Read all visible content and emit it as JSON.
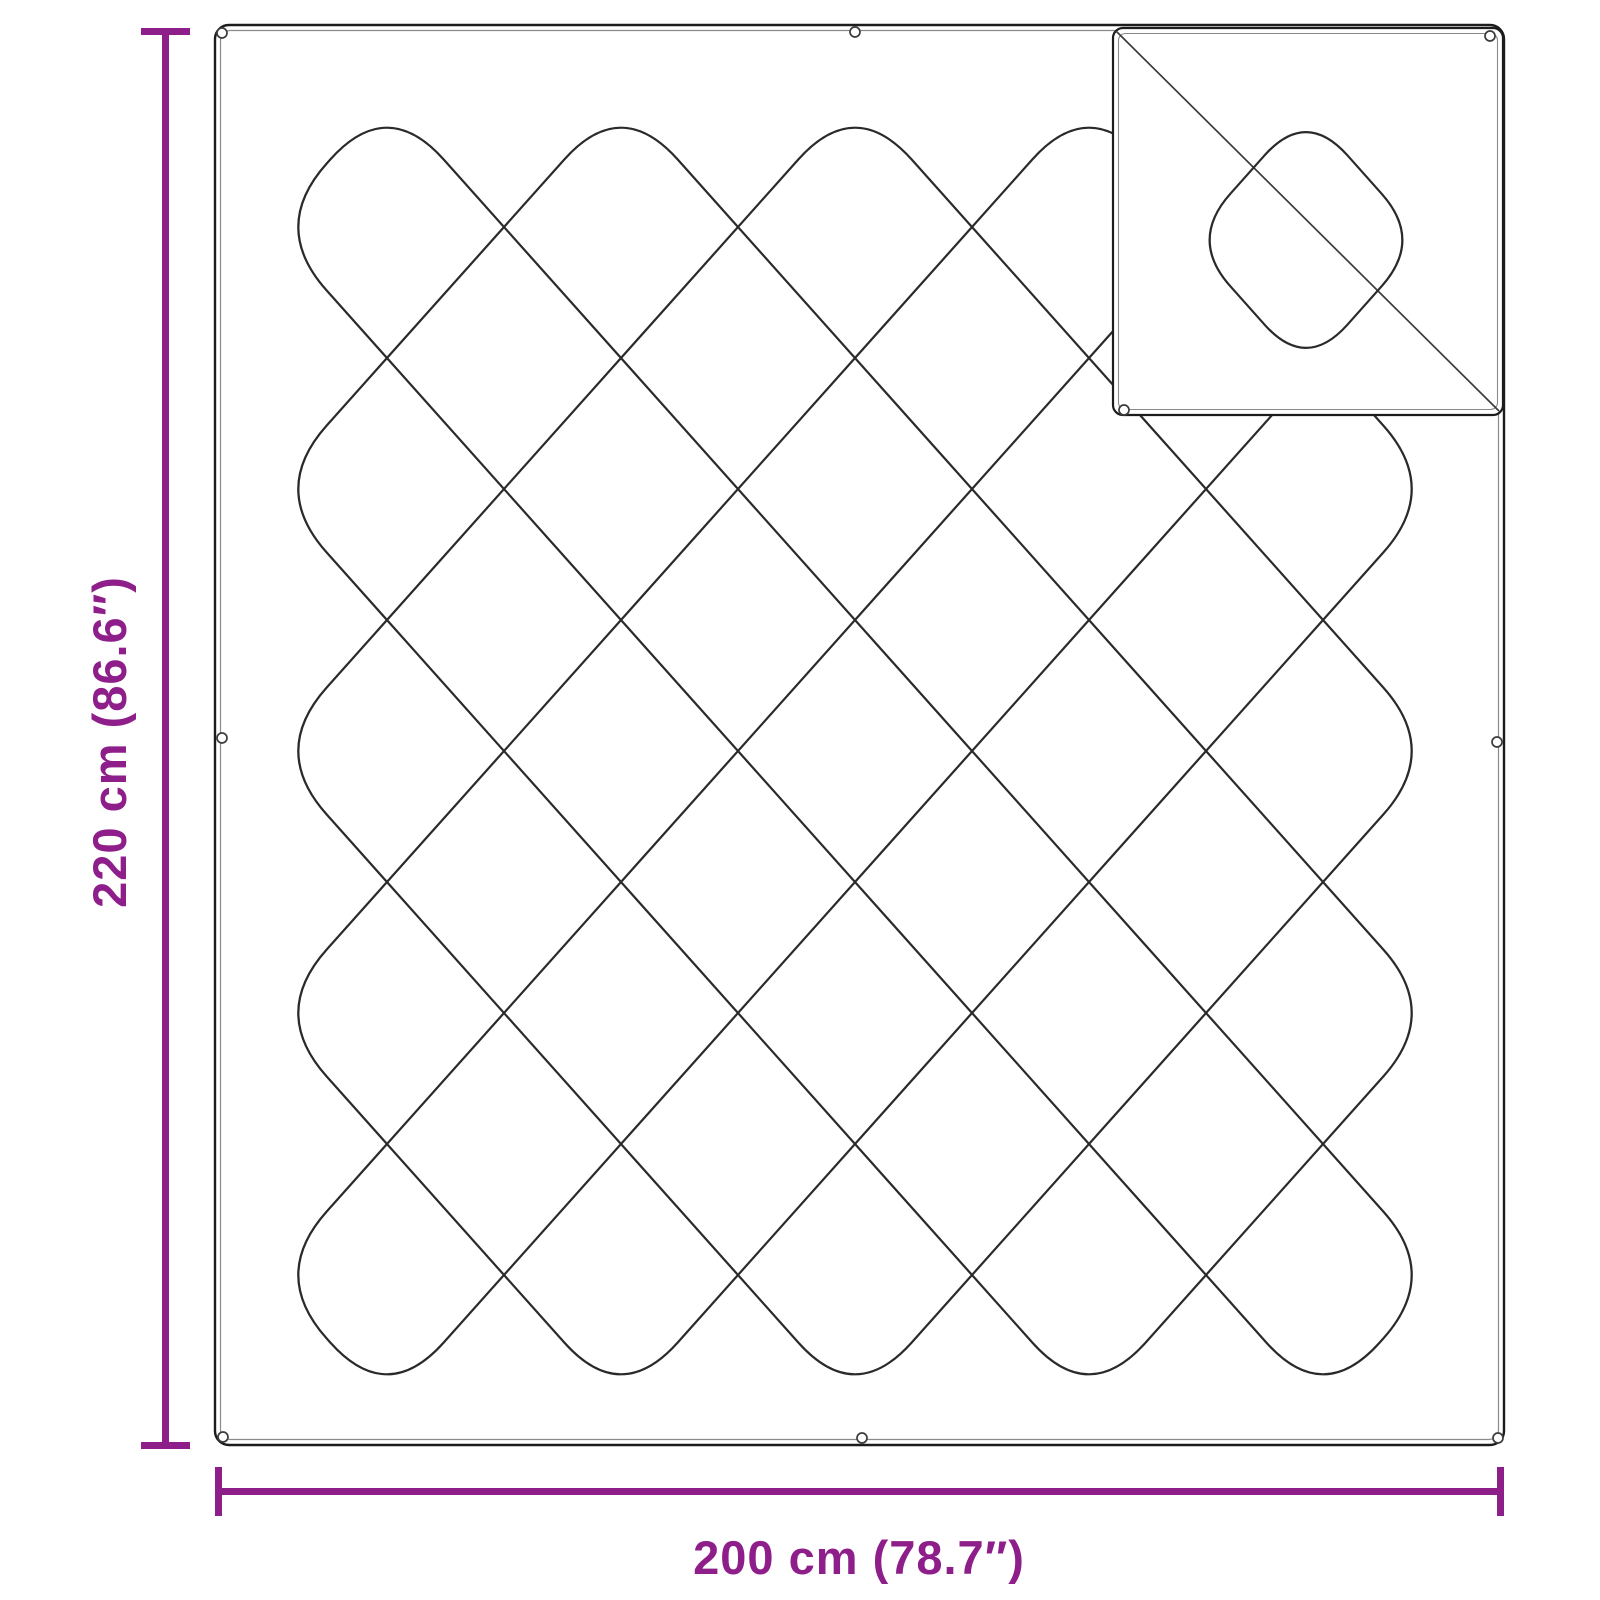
{
  "diagram": {
    "title": "blanket-dimension-diagram",
    "height_dimension": "220 cm (86.6″)",
    "width_dimension": "200 cm (78.7″)"
  },
  "colors": {
    "dimension_accent": "#8E1E8A",
    "stitch_line": "#2a2a2a",
    "outline": "#1c1c1c",
    "inner_outline": "#8a8a8a",
    "background": "#ffffff"
  },
  "icons": {
    "grommet": "eyelet-circle-icon"
  }
}
